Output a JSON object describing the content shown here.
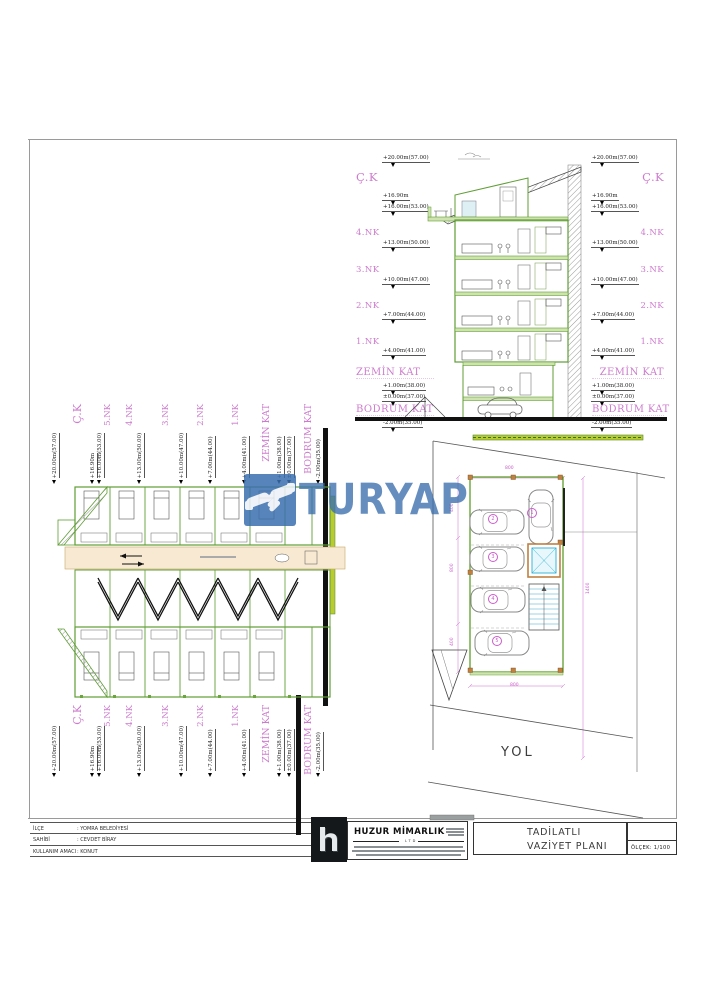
{
  "watermark": {
    "brand": "TURYAP",
    "color": "#3a6fae"
  },
  "road_label": "YOL",
  "colors": {
    "level_label_magenta": "#cd7ccd",
    "wall_green": "#5f9e35",
    "landscape_green": "#b9cc2f",
    "elevator_cyan": "#2ab3d6",
    "ground_black": "#111111",
    "watermark_blue": "#3a6fae"
  },
  "levels": {
    "section": [
      {
        "t": "E",
        "s": "+20.00m(57.00)"
      },
      {
        "t": "L",
        "s": "Ç.K",
        "size": "xl"
      },
      {
        "t": "E",
        "s": "+16.90m"
      },
      {
        "t": "E",
        "s": "+16.00m(53.00)"
      },
      {
        "t": "L",
        "s": "4.NK"
      },
      {
        "t": "E",
        "s": "+13.00m(50.00)"
      },
      {
        "t": "L",
        "s": "3.NK"
      },
      {
        "t": "E",
        "s": "+10.00m(47.00)"
      },
      {
        "t": "L",
        "s": "2.NK"
      },
      {
        "t": "E",
        "s": "+7.00m(44.00)"
      },
      {
        "t": "L",
        "s": "1.NK"
      },
      {
        "t": "E",
        "s": "+4.00m(41.00)"
      },
      {
        "t": "L",
        "s": "ZEMİN KAT",
        "size": "lg"
      },
      {
        "t": "E",
        "s": "+1.00m(38.00)"
      },
      {
        "t": "E",
        "s": "±0.00m(37.00)"
      },
      {
        "t": "L",
        "s": "BODRUM KAT",
        "size": "lg"
      },
      {
        "t": "E",
        "s": "-2.00m(35.00)"
      }
    ],
    "plan": [
      {
        "t": "E",
        "s": "+20.00m(57.00)"
      },
      {
        "t": "L",
        "s": "Ç.K",
        "size": "xl"
      },
      {
        "t": "E",
        "s": "+16.90m"
      },
      {
        "t": "E",
        "s": "+16.00m(53.00)"
      },
      {
        "t": "L",
        "s": "5.NK"
      },
      {
        "t": "L",
        "s": "4.NK"
      },
      {
        "t": "E",
        "s": "+13.00m(50.00)"
      },
      {
        "t": "L",
        "s": "3.NK"
      },
      {
        "t": "E",
        "s": "+10.00m(47.00)"
      },
      {
        "t": "L",
        "s": "2.NK"
      },
      {
        "t": "E",
        "s": "+7.00m(44.00)"
      },
      {
        "t": "L",
        "s": "1.NK"
      },
      {
        "t": "E",
        "s": "+4.00m(41.00)"
      },
      {
        "t": "L",
        "s": "ZEMİN KAT",
        "size": "lg"
      },
      {
        "t": "E",
        "s": "+1.00m(38.00)"
      },
      {
        "t": "E",
        "s": "±0.00m(37.00)"
      },
      {
        "t": "L",
        "s": "BODRUM KAT",
        "size": "lg"
      },
      {
        "t": "E",
        "s": "-2.00m(35.00)"
      }
    ]
  },
  "site_plan": {
    "parking_spots": [
      "1",
      "2",
      "3",
      "4",
      "5"
    ],
    "dimensions": [
      "800",
      "400",
      "800",
      "400",
      "800",
      "1400"
    ]
  },
  "title_block": {
    "rows": [
      {
        "label": "İLÇE",
        "value": ": YOMRA BELEDİYESİ"
      },
      {
        "label": "SAHİBİ",
        "value": ": CEVDET BİRAY"
      },
      {
        "label": "KULLANIM AMACI",
        "value": ": KONUT"
      }
    ],
    "firm": {
      "name": "HUZUR MİMARLIK",
      "sub": "LTD"
    },
    "drawing_title_line1": "TADİLATLI",
    "drawing_title_line2": "VAZİYET PLANI",
    "scale": "ÖLÇEK: 1/100"
  }
}
